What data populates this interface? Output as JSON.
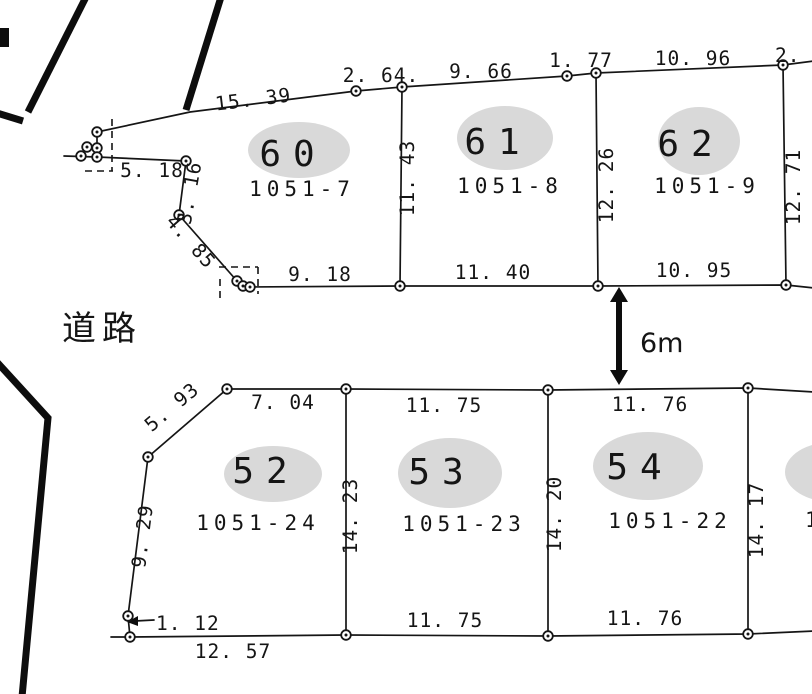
{
  "colors": {
    "background": "#ffffff",
    "ink": "#151515",
    "parcel_ellipse": "#d9d9d9"
  },
  "road_label": "道路",
  "gap_label": "6m",
  "upper_block": {
    "parcels": [
      {
        "number": "60",
        "lot": "1051-7"
      },
      {
        "number": "61",
        "lot": "1051-8"
      },
      {
        "number": "62",
        "lot": "1051-9"
      }
    ],
    "dims": {
      "top": [
        "15. 39",
        "2. 64.",
        "9. 66",
        "1. 77",
        "10. 96",
        "2. 0"
      ],
      "left": [
        "5. 18",
        "3. 16",
        "4. 85"
      ],
      "bottom": [
        "9. 18",
        "11. 40",
        "10. 95"
      ],
      "verticals": [
        "11. 43",
        "12. 26",
        "12. 71"
      ]
    }
  },
  "lower_block": {
    "parcels": [
      {
        "number": "52",
        "lot": "1051-24"
      },
      {
        "number": "53",
        "lot": "1051-23"
      },
      {
        "number": "54",
        "lot": "1051-22"
      }
    ],
    "partial_right_lot": "1",
    "dims": {
      "top": [
        "5. 93",
        "7. 04",
        "11. 75",
        "11. 76"
      ],
      "left": [
        "9. 29",
        "1. 12"
      ],
      "bottom": [
        "12. 57",
        "11. 75",
        "11. 76"
      ],
      "verticals": [
        "14. 23",
        "14. 20",
        "14. 17"
      ]
    }
  }
}
